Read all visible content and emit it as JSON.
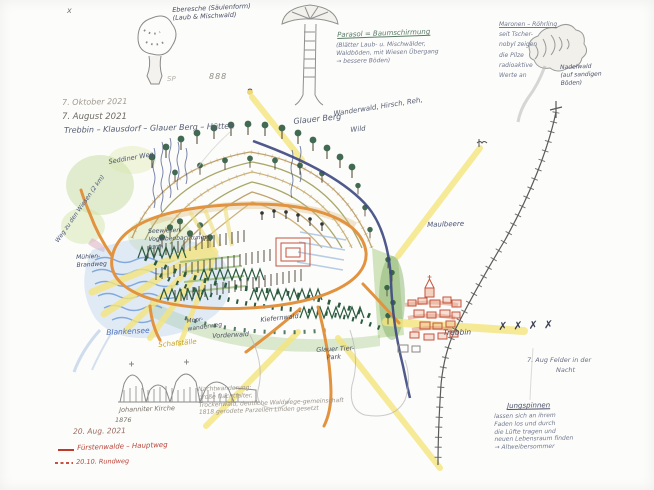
{
  "colors": {
    "paper": "#fcfcfa",
    "pencil_gray": "#8a8a8a",
    "ink_blue": "#4a4f66",
    "ray_yellow": "#f4e57e",
    "trail_orange": "#e2933f",
    "river_navy": "#3d477f",
    "water_blue": "#6f9bd6",
    "tree_dark_green": "#2c5a40",
    "meadow_green": "#9cc27c",
    "contour_tan": "#b99a5f",
    "town_red": "#c4553f",
    "label_blue": "#4a6fbb",
    "label_yellow": "#c9a227",
    "legend_red": "#c0392b"
  },
  "page": {
    "corner_mark": "x",
    "faint_marks": [
      "SP",
      "888"
    ]
  },
  "dates": {
    "line1": "7. Oktober 2021",
    "line2": "7. August 2021",
    "route": "Trebbin – Klausdorf – Glauer Berg – Hütten"
  },
  "top_sketches": {
    "eberesche_line1": "Eberesche (Säulenform)",
    "eberesche_line2": "(Laub & Mischwald)",
    "parasol_title": "Parasol = Baumschirmung",
    "parasol_lines": [
      "(Blätter Laub- u. Mischwälder,",
      "Waldböden, mit Wiesen Übergang",
      "→ bessere Böden)"
    ],
    "maronen_lines": [
      "Maronen – Röhrling",
      "seit Tscher-",
      "nobyl zeigen",
      "die Pilze",
      "radioaktive",
      "Werte an"
    ],
    "nadelwald_lines": [
      "Nadelwald",
      "(auf sandigen",
      "Böden)"
    ]
  },
  "map_labels": {
    "glauer_berg": "Glauer Berg",
    "glauer_sub": "Wanderwald, Hirsch, Reh,",
    "glauer_sub2": "Wild",
    "seddiner": "Seddiner Weg",
    "weg_vertical": "Weg zu den Wiesen (2 km)",
    "seewiesen": [
      "Seewiesen",
      "Vogelbeobachtungs-",
      "turm"
    ],
    "muehlen": [
      "Mühlen-",
      "Brandweg"
    ],
    "maulbeere": "Maulbeere",
    "tal": "Tal",
    "blankensee": "Blankensee",
    "schafstaelle": "Schafställe",
    "moorwiesen": [
      "Moor-",
      "wanderweg"
    ],
    "vorderwald": "Vorderwald",
    "kiefernwald": "Kiefernwald",
    "glauer_park": [
      "Glauer Tier-",
      "Park"
    ],
    "trebbin": "Trebbin",
    "x_marks": "✗✗✗✗"
  },
  "night_notes": {
    "lines": [
      "Nachtwanderung:",
      "große Nachtfalter,",
      "Trockenwald, deutliche Waldwege-gemeinschaft",
      "1818 gerodete Parzellen Linden gesetzt"
    ]
  },
  "right_notes": {
    "felder_line1": "7. Aug Felder in der",
    "felder_line2": "Nacht",
    "jung_title": "Jungspinnen",
    "jung_lines": [
      "lassen sich an ihrem",
      "Faden los und durch",
      "die Lüfte tragen und",
      "neuen Lebensraum finden",
      "→ Altweibersommer"
    ]
  },
  "bottom_left": {
    "kirche_line1": "Johanniter Kirche",
    "kirche_line2": "1876",
    "date": "20. Aug. 2021",
    "legend_solid": "Fürstenwalde – Hauptweg",
    "legend_dashed": "20.10. Rundweg"
  }
}
